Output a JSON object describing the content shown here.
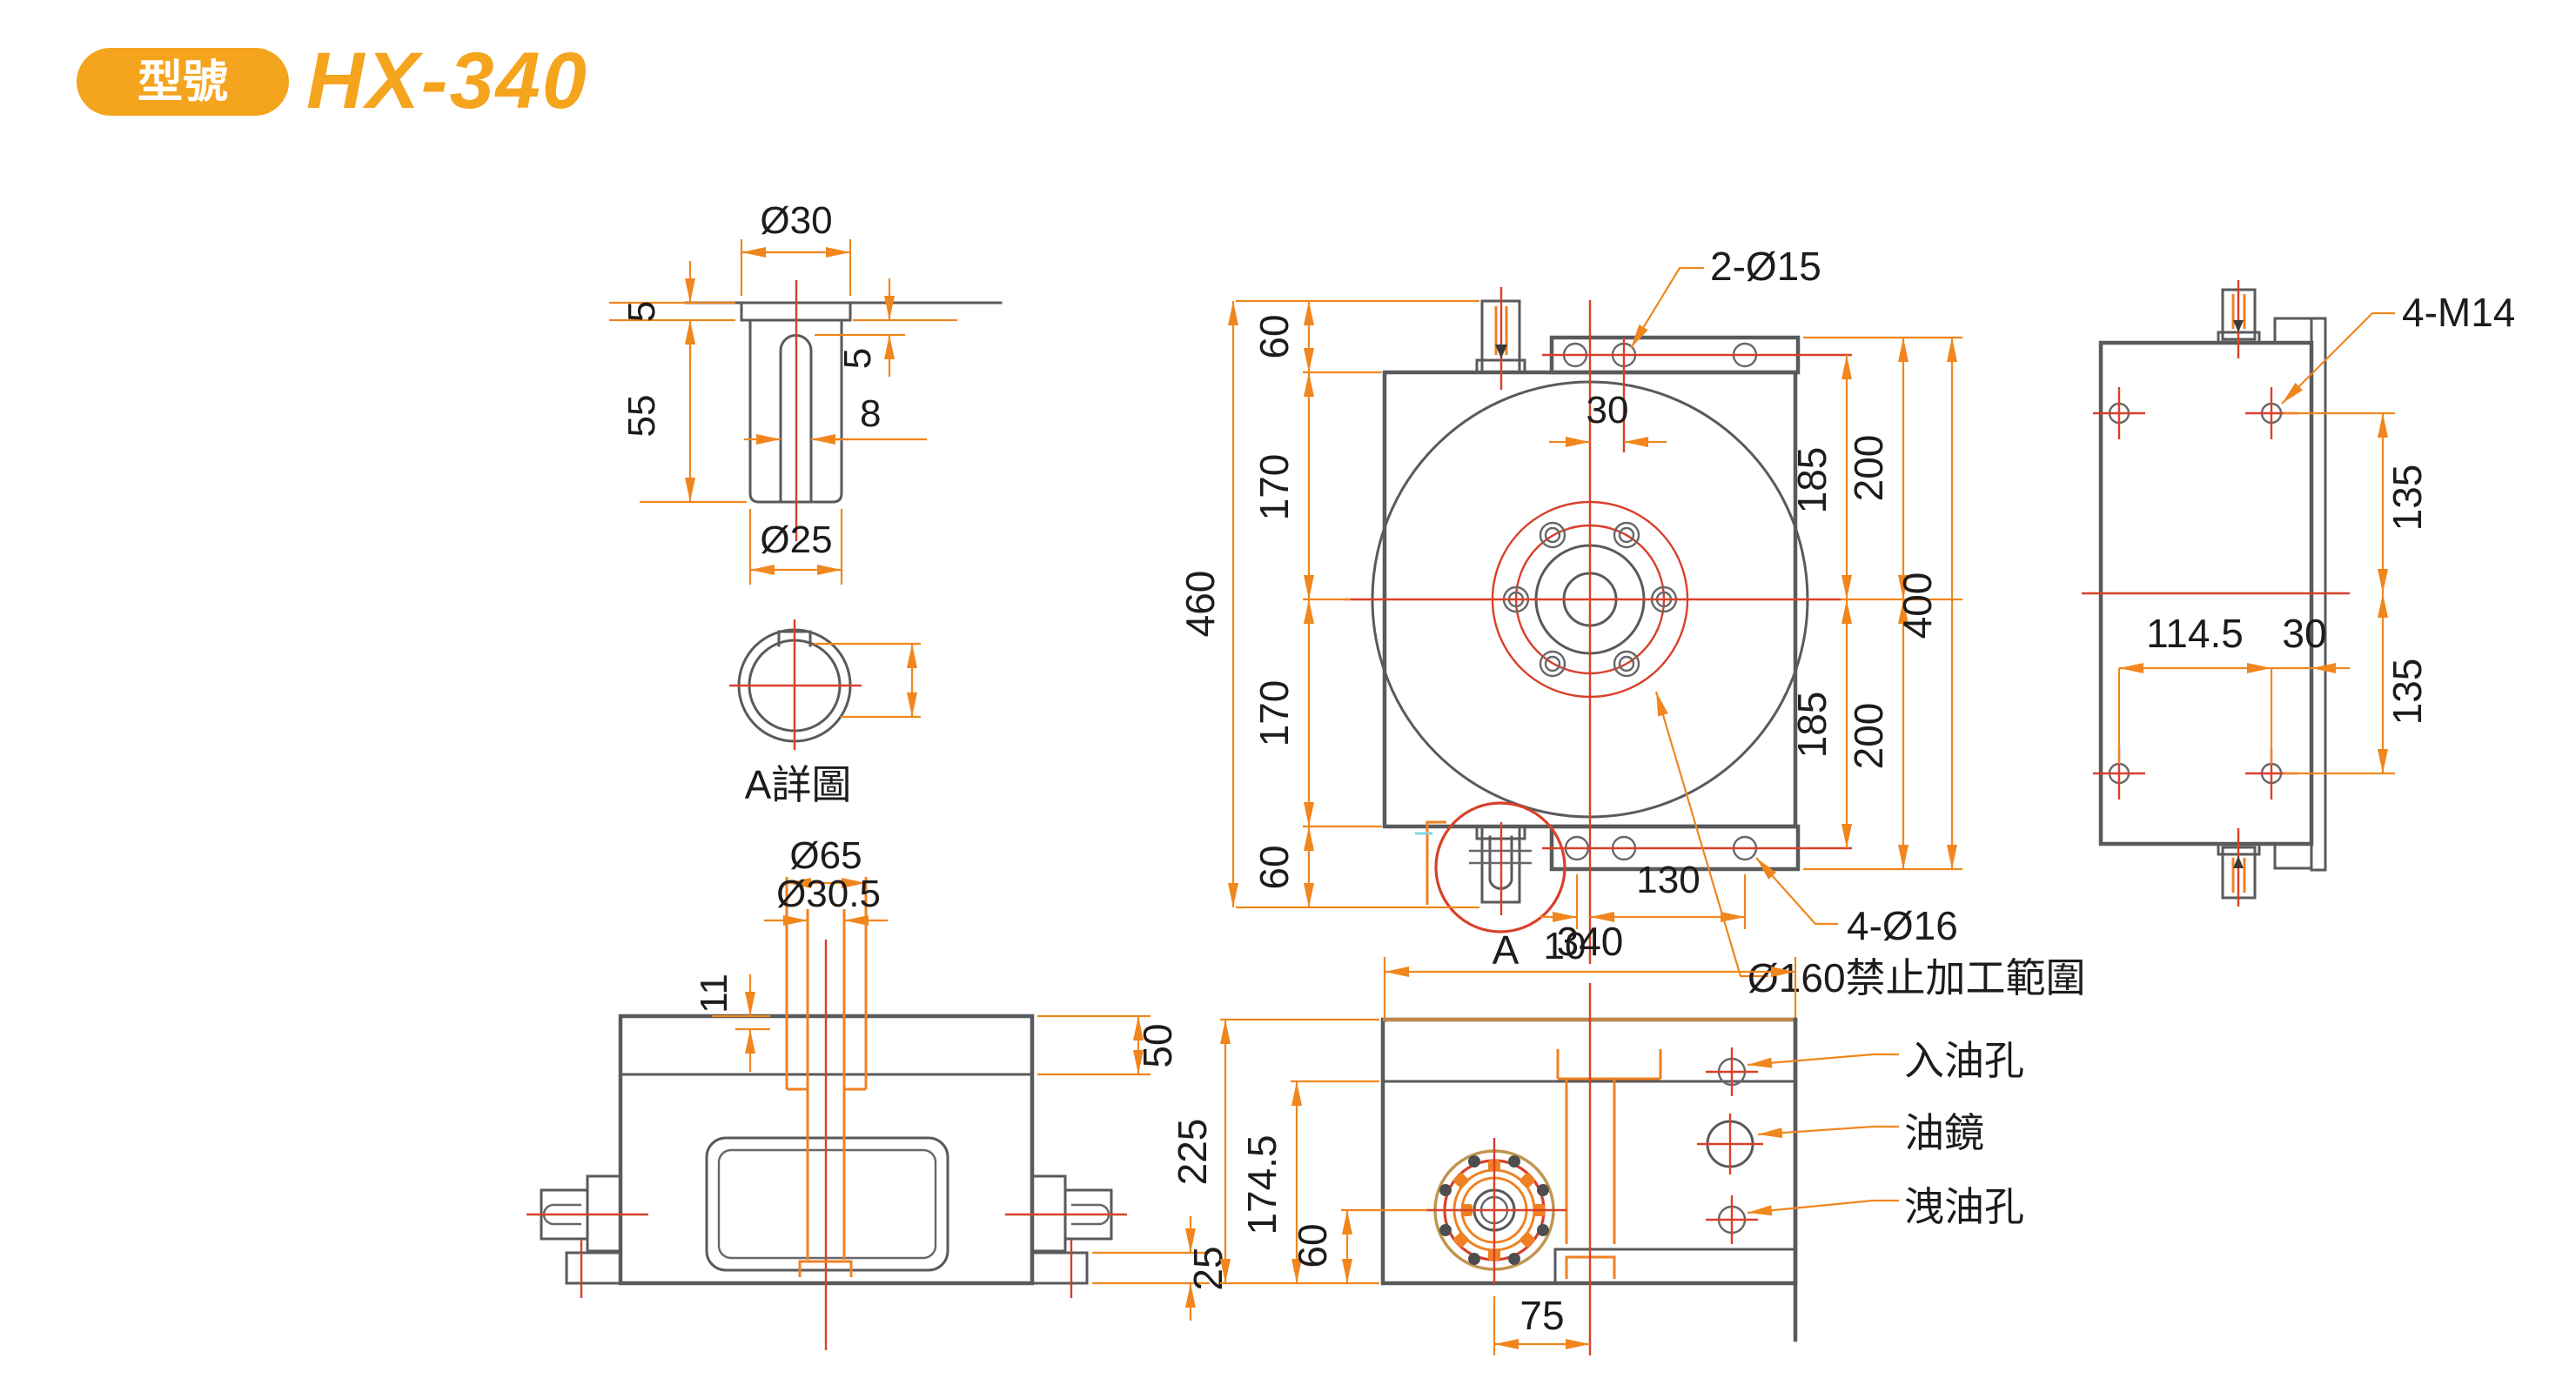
{
  "header": {
    "badge_label": "型號",
    "model": "HX-340"
  },
  "colors": {
    "accent_orange": "#F5A41E",
    "dim_orange": "#F0861D",
    "centerline_red": "#D8402A",
    "outline_gray": "#595a5c"
  },
  "detail_view": {
    "caption": "A詳圖",
    "dia_top": "Ø30",
    "flange_thickness": "5",
    "pin_length": "55",
    "slot_depth": "5",
    "slot_width": "8",
    "dia_bottom": "Ø25"
  },
  "top_view": {
    "overall_height": "460",
    "seg_top": "60",
    "seg_upper": "170",
    "seg_lower": "170",
    "seg_bottom": "60",
    "hole_offset": "30",
    "pitch_upper": "185",
    "edge_upper": "200",
    "pitch_lower": "185",
    "edge_lower": "200",
    "overall_width_dim": "400",
    "table_width": "340",
    "hole_pitch": "130",
    "center_offset": "10",
    "detail_mark": "A",
    "callout_top_holes": "2-Ø15",
    "callout_corner_holes": "4-Ø16",
    "callout_no_machining": "Ø160禁止加工範圍"
  },
  "side_view": {
    "callout_holes": "4-M14",
    "pitch_upper": "135",
    "pitch_lower": "135",
    "hole_span": "114.5",
    "edge_offset": "30"
  },
  "front_view": {
    "boss_dia": "Ø65",
    "bore_dia": "Ø30.5",
    "boss_height": "11",
    "plate_height": "50",
    "foot_height": "25"
  },
  "bottom_view": {
    "overall_height": "225",
    "body_height": "174.5",
    "shaft_height": "60",
    "shaft_offset": "75",
    "label_oil_inlet": "入油孔",
    "label_oil_sight": "油鏡",
    "label_oil_drain": "洩油孔"
  }
}
